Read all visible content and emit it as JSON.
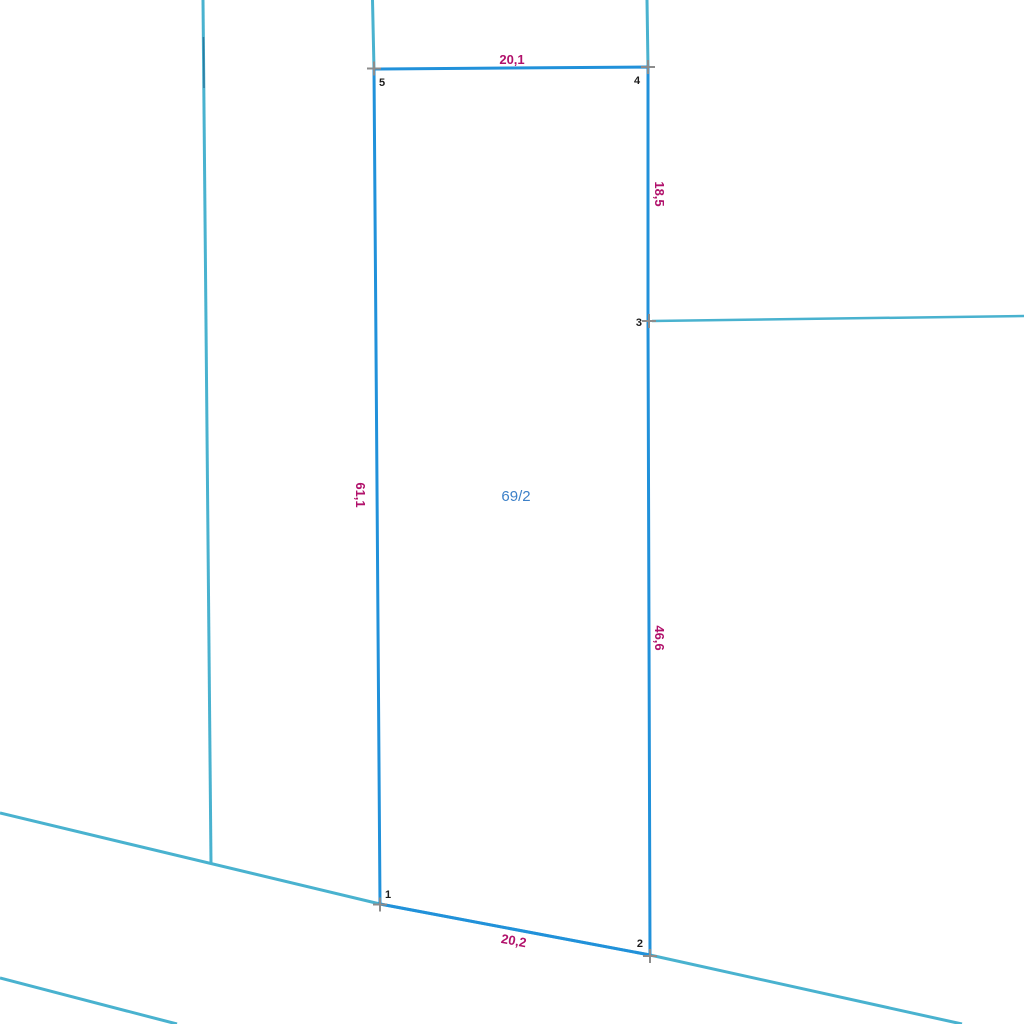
{
  "map": {
    "parcel": {
      "label": "69/2",
      "vertex_labels": {
        "v1": "1",
        "v2": "2",
        "v3": "3",
        "v4": "4",
        "v5": "5"
      },
      "dimensions": {
        "top": "20,1",
        "right_upper": "18,5",
        "right_lower": "46,6",
        "left": "61,1",
        "bottom": "20,2"
      }
    },
    "colors": {
      "parcel_boundary": "#2191DA",
      "adjacent_boundary": "#49B2CF",
      "boundary_overlap": "#2B7AA0",
      "dimension_text": "#B1116B",
      "vertex_text": "#1C1C1C",
      "parcel_text": "#3C80C8",
      "survey_marker": "#8C8C8C",
      "background": "#FFFFFF"
    }
  }
}
